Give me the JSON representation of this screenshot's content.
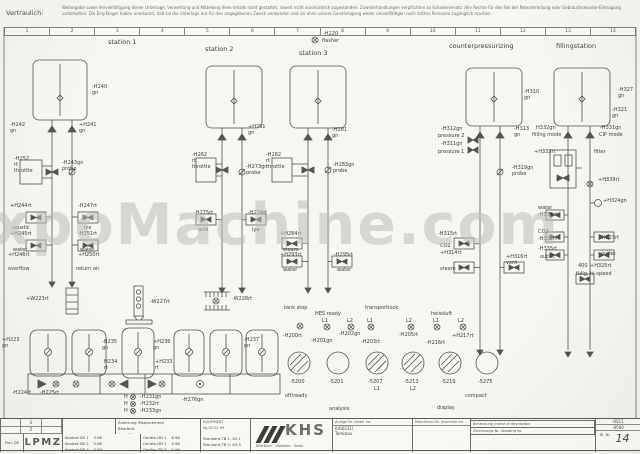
{
  "header": {
    "confidential": "Vertraulich:",
    "notice_line1": "Weitergabe sowie Vervielfältigung dieser Unterlage, Verwertung und Mitteilung ihres Inhalts nicht gestattet, soweit nicht ausdrücklich zugestanden. Zuwiderhandlungen verpflichten zu Schadenersatz. Alle Rechte für den Fall der Patenterteilung oder Gebrauchsmuster-Eintragung vorbehalten.",
    "notice_line2": "Die Empfänger haben anerkannt, daß sie die Unterlage nur für den angegebenen Zweck verwenden und sie ohne unsere Genehmigung weder vervielfältigen noch dritten Personen zugänglich machen."
  },
  "watermark": "ExpoMachine.com",
  "ruler_numbers": [
    "1",
    "2",
    "3",
    "4",
    "5",
    "6",
    "7",
    "8",
    "9",
    "10",
    "11",
    "12",
    "13",
    "14"
  ],
  "labels": [
    {
      "t": "station 1",
      "x": 108,
      "y": 39,
      "fs": 6.5
    },
    {
      "t": "station 2",
      "x": 205,
      "y": 46,
      "fs": 6.5
    },
    {
      "t": "station 3",
      "x": 299,
      "y": 50,
      "fs": 6.5
    },
    {
      "t": "counterpressurizing",
      "x": 449,
      "y": 43,
      "fs": 6.5
    },
    {
      "t": "fillingstation",
      "x": 556,
      "y": 43,
      "fs": 6.5
    },
    {
      "t": "-H220",
      "x": 323,
      "y": 31
    },
    {
      "t": "flasher",
      "x": 322,
      "y": 38
    },
    {
      "t": "-H240\ngn",
      "x": 92,
      "y": 84
    },
    {
      "t": "-H242\ngn",
      "x": 10,
      "y": 122
    },
    {
      "t": "+H241\ngn",
      "x": 79,
      "y": 122
    },
    {
      "t": "-H252\nrt\nthrottle",
      "x": 14,
      "y": 156
    },
    {
      "t": "-H243gn\nprobe",
      "x": 62,
      "y": 160
    },
    {
      "t": "+H244rt",
      "x": 10,
      "y": 203
    },
    {
      "t": "caustic",
      "x": 12,
      "y": 225
    },
    {
      "t": "-H247rt",
      "x": 78,
      "y": 203
    },
    {
      "t": "lye",
      "x": 84,
      "y": 225
    },
    {
      "t": "+H245rt",
      "x": 10,
      "y": 231
    },
    {
      "t": "water",
      "x": 13,
      "y": 247
    },
    {
      "t": "+H246rt",
      "x": 8,
      "y": 252
    },
    {
      "t": "overflow",
      "x": 8,
      "y": 266
    },
    {
      "t": "-H251rt",
      "x": 78,
      "y": 231
    },
    {
      "t": "water",
      "x": 80,
      "y": 247
    },
    {
      "t": "+H250rt",
      "x": 78,
      "y": 252
    },
    {
      "t": "return air",
      "x": 76,
      "y": 266
    },
    {
      "t": "+H261\ngn",
      "x": 248,
      "y": 124
    },
    {
      "t": "-H262\nrt\nthrottle",
      "x": 192,
      "y": 152
    },
    {
      "t": "-H273gn\nprobe",
      "x": 246,
      "y": 164
    },
    {
      "t": "-H275rt",
      "x": 194,
      "y": 210
    },
    {
      "t": "acid",
      "x": 198,
      "y": 227
    },
    {
      "t": "-H274rt",
      "x": 248,
      "y": 210
    },
    {
      "t": "lye",
      "x": 252,
      "y": 227
    },
    {
      "t": "-H281\ngn",
      "x": 332,
      "y": 127
    },
    {
      "t": "-H282\nrt\nthrottle",
      "x": 266,
      "y": 152
    },
    {
      "t": "-H283gn\nprobe",
      "x": 333,
      "y": 162
    },
    {
      "t": "+H284rt",
      "x": 280,
      "y": 231
    },
    {
      "t": "steam",
      "x": 283,
      "y": 247
    },
    {
      "t": "+H293rt",
      "x": 280,
      "y": 252
    },
    {
      "t": "water",
      "x": 283,
      "y": 267
    },
    {
      "t": "-H295rt",
      "x": 334,
      "y": 252
    },
    {
      "t": "water",
      "x": 337,
      "y": 267
    },
    {
      "t": "-H310\ngn",
      "x": 524,
      "y": 89
    },
    {
      "t": "-H312gn",
      "x": 441,
      "y": 126
    },
    {
      "t": "pressure 2",
      "x": 438,
      "y": 133
    },
    {
      "t": "-H311gn",
      "x": 441,
      "y": 141
    },
    {
      "t": "pressure 1",
      "x": 438,
      "y": 149
    },
    {
      "t": "-H313\ngn",
      "x": 514,
      "y": 126
    },
    {
      "t": "-H319gn\nprobe",
      "x": 512,
      "y": 165
    },
    {
      "t": "-H315rt",
      "x": 438,
      "y": 231
    },
    {
      "t": "CO2",
      "x": 440,
      "y": 243
    },
    {
      "t": "+H314rt",
      "x": 440,
      "y": 250
    },
    {
      "t": "steam",
      "x": 440,
      "y": 266
    },
    {
      "t": "+H316rt\nvent",
      "x": 506,
      "y": 254
    },
    {
      "t": "-H327\ngn",
      "x": 618,
      "y": 87
    },
    {
      "t": "-H321\ngn",
      "x": 612,
      "y": 107
    },
    {
      "t": "H332gn",
      "x": 536,
      "y": 125
    },
    {
      "t": "filling mode",
      "x": 532,
      "y": 132
    },
    {
      "t": "-H331gn",
      "x": 600,
      "y": 125
    },
    {
      "t": "CIP mode",
      "x": 599,
      "y": 132
    },
    {
      "t": "+H333rt",
      "x": 534,
      "y": 149
    },
    {
      "t": "filter",
      "x": 594,
      "y": 149
    },
    {
      "t": "+H339rt",
      "x": 598,
      "y": 177
    },
    {
      "t": "+H324gn",
      "x": 603,
      "y": 198
    },
    {
      "t": "water",
      "x": 538,
      "y": 205
    },
    {
      "t": "-H338rt",
      "x": 538,
      "y": 212
    },
    {
      "t": "CO2",
      "x": 538,
      "y": 229
    },
    {
      "t": "-H337rt",
      "x": 538,
      "y": 236
    },
    {
      "t": "-H335rt",
      "x": 538,
      "y": 246
    },
    {
      "t": "outlet",
      "x": 540,
      "y": 254
    },
    {
      "t": "-H323rt",
      "x": 600,
      "y": 235
    },
    {
      "t": "outlet",
      "x": 601,
      "y": 251
    },
    {
      "t": "400",
      "x": 578,
      "y": 263
    },
    {
      "t": "+H325rt",
      "x": 590,
      "y": 263
    },
    {
      "t": "füllg. hi-speed",
      "x": 576,
      "y": 271
    },
    {
      "t": "+W223rt",
      "x": 26,
      "y": 296
    },
    {
      "t": "-W227rt",
      "x": 150,
      "y": 299
    },
    {
      "t": "-W228rt",
      "x": 232,
      "y": 296
    },
    {
      "t": "+H223\ngn",
      "x": 2,
      "y": 337
    },
    {
      "t": "-H235\ngn",
      "x": 102,
      "y": 339
    },
    {
      "t": "H234\nrt",
      "x": 104,
      "y": 359
    },
    {
      "t": "+H236\ngn",
      "x": 153,
      "y": 339
    },
    {
      "t": "+H233\nrt",
      "x": 155,
      "y": 359
    },
    {
      "t": "-H237\ngn",
      "x": 244,
      "y": 337
    },
    {
      "t": "-H224rt",
      "x": 12,
      "y": 390
    },
    {
      "t": "-H225rt",
      "x": 40,
      "y": 390
    },
    {
      "t": "H",
      "x": 124,
      "y": 394
    },
    {
      "t": "H",
      "x": 124,
      "y": 401
    },
    {
      "t": "H",
      "x": 124,
      "y": 408
    },
    {
      "t": "-H231gn",
      "x": 140,
      "y": 394
    },
    {
      "t": "-H232rt",
      "x": 140,
      "y": 401
    },
    {
      "t": "-H233gn",
      "x": 140,
      "y": 408
    },
    {
      "t": "-H276gn",
      "x": 182,
      "y": 397
    },
    {
      "t": "tank stop",
      "x": 284,
      "y": 305
    },
    {
      "t": "-H200rt",
      "x": 283,
      "y": 333
    },
    {
      "t": "HES ready",
      "x": 315,
      "y": 311
    },
    {
      "t": "L1",
      "x": 322,
      "y": 318
    },
    {
      "t": "L2",
      "x": 347,
      "y": 318
    },
    {
      "t": "-H201gn",
      "x": 311,
      "y": 338
    },
    {
      "t": "-H202gn",
      "x": 339,
      "y": 331
    },
    {
      "t": "transportlock",
      "x": 365,
      "y": 305
    },
    {
      "t": "L1",
      "x": 367,
      "y": 318
    },
    {
      "t": "L2",
      "x": 406,
      "y": 318
    },
    {
      "t": "-H203rt",
      "x": 361,
      "y": 339
    },
    {
      "t": "-H205rt",
      "x": 399,
      "y": 332
    },
    {
      "t": "heissluft",
      "x": 431,
      "y": 311
    },
    {
      "t": "L1",
      "x": 433,
      "y": 318
    },
    {
      "t": "L2",
      "x": 458,
      "y": 318
    },
    {
      "t": "-H216rt",
      "x": 426,
      "y": 340
    },
    {
      "t": "+H217rt",
      "x": 452,
      "y": 333
    },
    {
      "t": "-5200",
      "x": 290,
      "y": 379
    },
    {
      "t": "-5201",
      "x": 329,
      "y": 379
    },
    {
      "t": "-5207",
      "x": 368,
      "y": 379
    },
    {
      "t": "L1",
      "x": 374,
      "y": 386
    },
    {
      "t": "-5213",
      "x": 404,
      "y": 379
    },
    {
      "t": "L2",
      "x": 410,
      "y": 386
    },
    {
      "t": "-5216",
      "x": 441,
      "y": 379
    },
    {
      "t": "-5275",
      "x": 478,
      "y": 379
    },
    {
      "t": "off/ready",
      "x": 285,
      "y": 393
    },
    {
      "t": "analysis",
      "x": 329,
      "y": 406
    },
    {
      "t": "display",
      "x": 437,
      "y": 405
    },
    {
      "t": "compact",
      "x": 465,
      "y": 393
    }
  ],
  "titleblock": {
    "rev_cells": [
      "",
      "S",
      "",
      "",
      "Z",
      ""
    ],
    "plan_label": "Plan DB",
    "code": "LPMZ",
    "change_rows": [
      "Änderung /Replacement",
      "Bearbeit.",
      "Geprüft"
    ],
    "equipment": "EQUIPMENT",
    "sign_date": "Kg   07.01.99",
    "rows_left": [
      "Konbat DB 1    3.98",
      "Konbat DB 2    5.98",
      "Konbat DB 3    5.99"
    ],
    "rows_mid": [
      "Geräte-DB 1    8.98",
      "Geräte-DB 2    9.98",
      "Geräte-DB 3    9.99"
    ],
    "standards": [
      "Standard-TB 1: 63.1",
      "Standard-TB 2: 63.3"
    ],
    "brand": "KHS",
    "brand_sub": "Klöckner · Holstein · Seitz",
    "order_header": "Anlage Nr. /order no.",
    "order_no": "IU60231/",
    "order_name": "Tomislav",
    "machine_header": "Maschinen-Nr. /machine no.",
    "name_header": "Benennung /name of description",
    "drawing_header": "Zeichnungs-Nr. /drawing no.",
    "doc_code1": "-0SC1",
    "doc_code2": "-0500",
    "sheet_label": "Bl. Nr.",
    "sheet_number": "14"
  }
}
